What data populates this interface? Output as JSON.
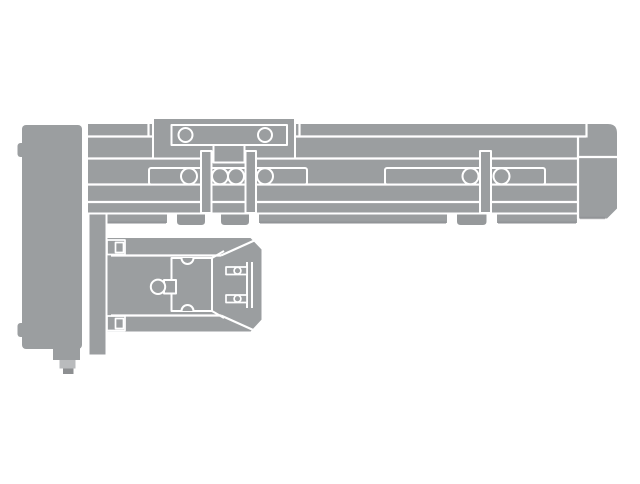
{
  "figure": {
    "description": "Gray technical line drawing of an electric linear actuator slide unit: motor housing block on the left with a connector plug, a long horizontal guide rail with top carriage, rollers, clamp bars, mounting feet and a rounded right end cap, plus a lower slider table assembly attached below on the left.",
    "text_visible": "none"
  },
  "parts": {
    "motor_housing": "Motor housing block",
    "connector_plug": "Motor connector plug",
    "mounting_plate": "Vertical mounting plate",
    "rail_body": "Guide rail extrusion body",
    "end_cap": "Right end cap",
    "carriage": "Top carriage with two mounting holes",
    "guide_slots": "Recessed guide slots",
    "rollers": "Guide rollers",
    "clamp_bars": "Sensor clamp bars",
    "mounting_feet": "Mounting feet tabs",
    "slider_table": "Lower slider table assembly",
    "slider_bracket": "Slider end bracket with screws"
  },
  "colors": {
    "background": "#ffffff",
    "body_gray": "#9b9ea0",
    "foot_gray": "#96999b",
    "shadow_gray": "#8a8d8f",
    "light_gray": "#b9bbbd",
    "dark_gray": "#8d8f91",
    "outline_white": "#ffffff"
  }
}
